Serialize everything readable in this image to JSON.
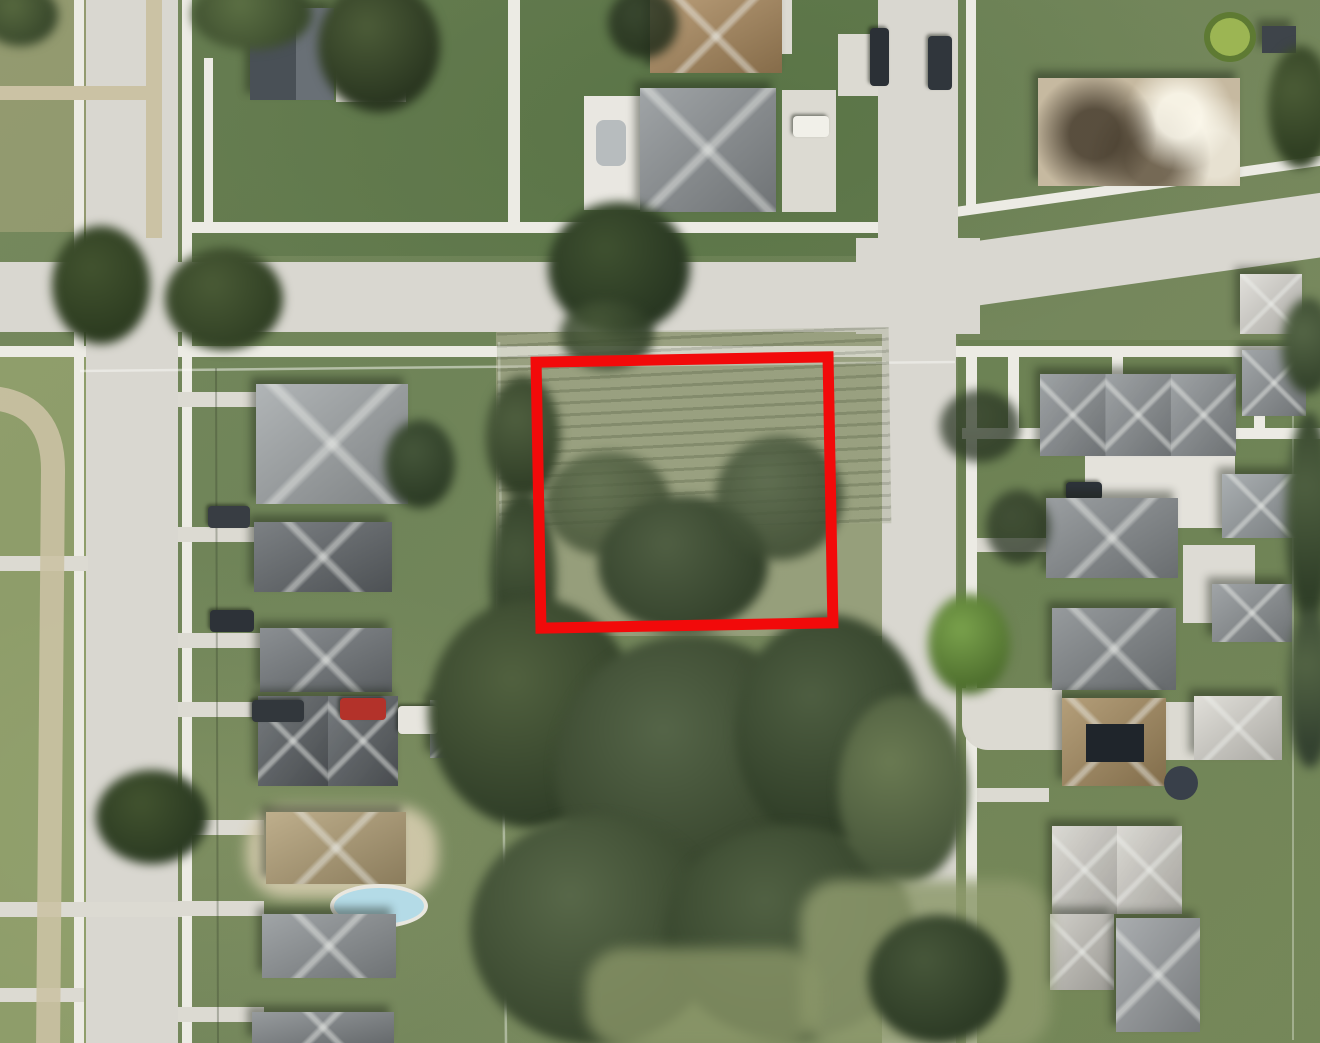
{
  "scene": {
    "description": "Aerial satellite photo of a residential neighborhood block; a vacant grassy parcel with trees is outlined by a red rectangle at center, bordered by streets, sidewalks and rows of houses",
    "parcel_outline": {
      "shape": "rectangle",
      "color": "#f20a0a",
      "stroke_px": 11
    }
  },
  "colors": {
    "highlight_red": "#f20a0a",
    "road_gray": "#d9d7d0",
    "sidewalk_white": "#ecebe4",
    "grass_green": "#76895c",
    "lot_sage": "#99a17e",
    "woods_green": "#57674a",
    "dirt_tan": "#cbc2a4",
    "roof_gray": "#8e9396",
    "roof_dark": "#545a60",
    "roof_tan": "#ab8a5e",
    "roof_white": "#dbd9d2",
    "pool_blue": "#b4dbe7",
    "pond_green": "#9cb553",
    "car_red": "#b3322a"
  }
}
